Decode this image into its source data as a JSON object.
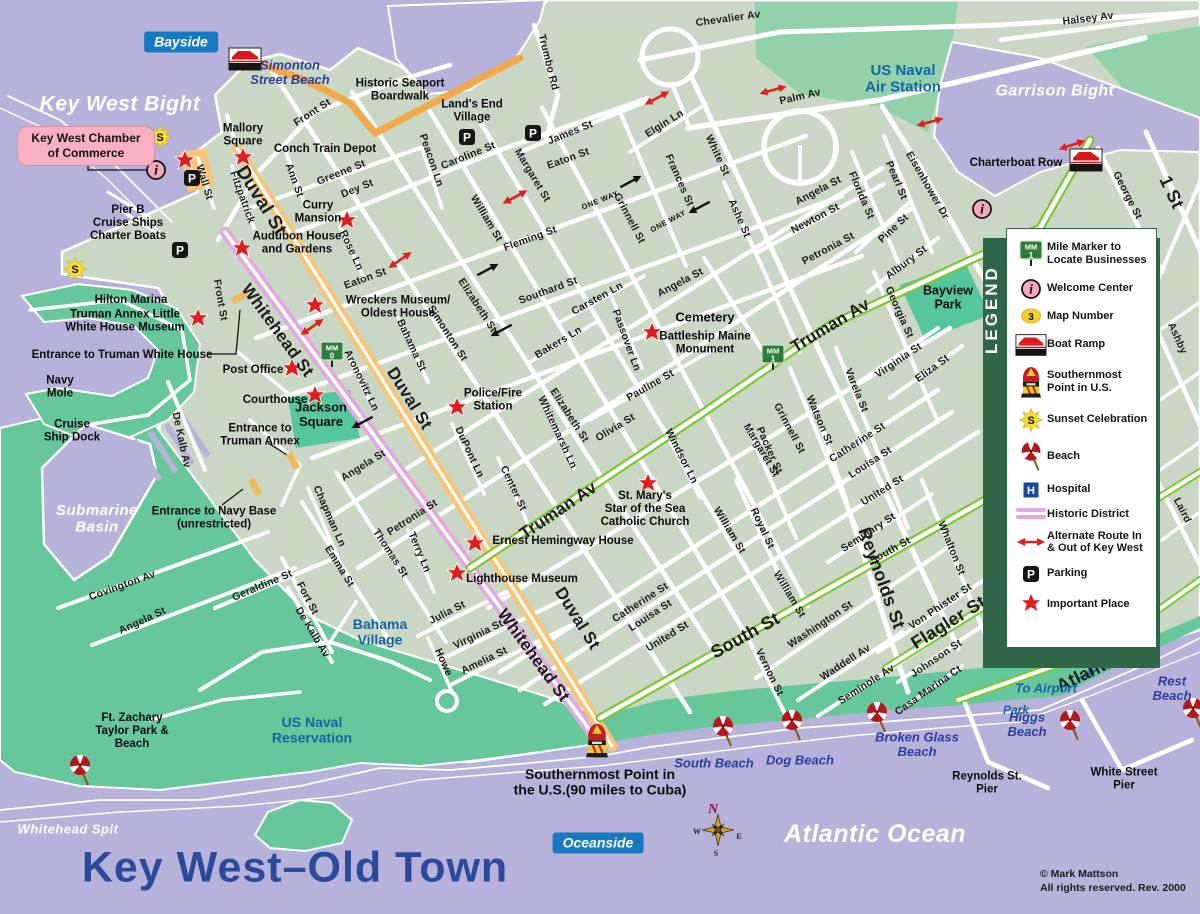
{
  "title": {
    "text": "Key West–Old Town"
  },
  "attribution": {
    "line1": "© Mark Mattson",
    "line2": "All rights reserved. Rev. 2000"
  },
  "badges": [
    {
      "text": "Bayside",
      "x": 181,
      "y": 42
    },
    {
      "text": "Oceanside",
      "x": 598,
      "y": 843
    }
  ],
  "chamber_box": {
    "line1": "Key West Chamber",
    "line2": "of Commerce"
  },
  "water_labels": [
    {
      "t": "Key West Bight",
      "x": 120,
      "y": 103,
      "s": 21
    },
    {
      "t": "Garrison Bight",
      "x": 1055,
      "y": 90,
      "s": 16
    },
    {
      "t": "Submarine\nBasin",
      "x": 97,
      "y": 518,
      "s": 15
    },
    {
      "t": "Whitehead Spit",
      "x": 68,
      "y": 829,
      "s": 13
    },
    {
      "t": "Atlantic Ocean",
      "x": 875,
      "y": 833,
      "s": 25
    }
  ],
  "area_labels": [
    {
      "t": "US Naval\nAir Station",
      "x": 903,
      "y": 78,
      "s": 15
    },
    {
      "t": "US Naval\nReservation",
      "x": 312,
      "y": 730,
      "s": 14
    },
    {
      "t": "Bahama\nVillage",
      "x": 380,
      "y": 632,
      "s": 14
    }
  ],
  "transit_labels": [
    {
      "t": "To Airport",
      "x": 1046,
      "y": 688,
      "s": 13
    },
    {
      "t": "Park",
      "x": 1016,
      "y": 710,
      "s": 12
    }
  ],
  "beach_labels": [
    {
      "t": "Simonton\nStreet Beach",
      "x": 290,
      "y": 72,
      "s": 13
    },
    {
      "t": "South Beach",
      "x": 714,
      "y": 763,
      "s": 13
    },
    {
      "t": "Dog Beach",
      "x": 800,
      "y": 760,
      "s": 13
    },
    {
      "t": "Broken Glass\nBeach",
      "x": 917,
      "y": 744,
      "s": 13
    },
    {
      "t": "Higgs\nBeach",
      "x": 1027,
      "y": 724,
      "s": 13
    },
    {
      "t": "Rest\nBeach",
      "x": 1172,
      "y": 688,
      "s": 13
    }
  ],
  "poi_labels": [
    {
      "t": "Mallory\nSquare",
      "x": 243,
      "y": 134
    },
    {
      "t": "Conch Train Depot",
      "x": 325,
      "y": 148
    },
    {
      "t": "Curry\nMansion",
      "x": 318,
      "y": 211
    },
    {
      "t": "Audubon House\nand Gardens",
      "x": 297,
      "y": 242
    },
    {
      "t": "Historic Seaport\nBoardwalk",
      "x": 400,
      "y": 89
    },
    {
      "t": "Land's End\nVillage",
      "x": 472,
      "y": 110
    },
    {
      "t": "Wreckers Museum/\nOldest House",
      "x": 398,
      "y": 306
    },
    {
      "t": "Truman Annex Little\nWhite House Museum",
      "x": 125,
      "y": 320
    },
    {
      "t": "Entrance to Truman White House",
      "x": 122,
      "y": 354
    },
    {
      "t": "Post Office",
      "x": 253,
      "y": 369
    },
    {
      "t": "Courthouse",
      "x": 275,
      "y": 399
    },
    {
      "t": "Jackson\nSquare",
      "x": 321,
      "y": 414,
      "s": 13
    },
    {
      "t": "Entrance to\nTruman Annex",
      "x": 260,
      "y": 434
    },
    {
      "t": "Entrance to Navy Base\n(unrestricted)",
      "x": 214,
      "y": 517
    },
    {
      "t": "Police/Fire\nStation",
      "x": 493,
      "y": 399
    },
    {
      "t": "Cemetery",
      "x": 705,
      "y": 317,
      "s": 13
    },
    {
      "t": "Battleship Maine\nMonument",
      "x": 705,
      "y": 342
    },
    {
      "t": "St. Mary's\nStar of the Sea\nCatholic Church",
      "x": 645,
      "y": 508
    },
    {
      "t": "Ernest Hemingway House",
      "x": 563,
      "y": 540
    },
    {
      "t": "Lighthouse Museum",
      "x": 522,
      "y": 578
    },
    {
      "t": "Pier B\nCruise Ships\nCharter Boats",
      "x": 128,
      "y": 222
    },
    {
      "t": "Hilton Marina",
      "x": 131,
      "y": 299
    },
    {
      "t": "Navy\nMole",
      "x": 60,
      "y": 386
    },
    {
      "t": "Cruise\nShip Dock",
      "x": 72,
      "y": 430
    },
    {
      "t": "Ft. Zachary\nTaylor Park &\nBeach",
      "x": 132,
      "y": 730
    },
    {
      "t": "Charterboat Row",
      "x": 1016,
      "y": 162
    },
    {
      "t": "Reynolds St.\nPier",
      "x": 987,
      "y": 782
    },
    {
      "t": "White Street\nPier",
      "x": 1124,
      "y": 778
    },
    {
      "t": "Bayview\nPark",
      "x": 948,
      "y": 297,
      "s": 12.5
    }
  ],
  "southernmost": {
    "t": "Southernmost Point in\nthe U.S.(90 miles to Cuba)",
    "x": 600,
    "y": 782,
    "s": 14
  },
  "street_labels": [
    [
      "Front St",
      312,
      112,
      -33
    ],
    [
      "Front St",
      221,
      300,
      80
    ],
    [
      "Wall St",
      205,
      182,
      73
    ],
    [
      "Fitzpatrick",
      243,
      197,
      70
    ],
    [
      "Ann St",
      295,
      180,
      70
    ],
    [
      "Greene St",
      341,
      172,
      -22
    ],
    [
      "Dey St",
      357,
      188,
      -22
    ],
    [
      "Caroline St",
      468,
      155,
      -22
    ],
    [
      "Peacon Ln",
      432,
      160,
      71
    ],
    [
      "James St",
      570,
      132,
      -22
    ],
    [
      "Trumbo Rd",
      549,
      62,
      76
    ],
    [
      "Chevalier Av",
      728,
      18,
      -8
    ],
    [
      "Halsey Av",
      1088,
      18,
      -7
    ],
    [
      "Palm Av",
      800,
      96,
      -13
    ],
    [
      "Elgin Ln",
      664,
      123,
      -32
    ],
    [
      "Eaton St",
      365,
      278,
      -20
    ],
    [
      "Eaton St",
      568,
      158,
      -20
    ],
    [
      "Fleming St",
      530,
      238,
      -20
    ],
    [
      "Southard St",
      548,
      290,
      -20
    ],
    [
      "Angela St",
      363,
      465,
      -32
    ],
    [
      "Angela St",
      680,
      282,
      -28
    ],
    [
      "Angela St",
      818,
      190,
      -28
    ],
    [
      "Angela St",
      142,
      620,
      -25
    ],
    [
      "Petronia St",
      412,
      517,
      -33
    ],
    [
      "Petronia St",
      828,
      248,
      -28
    ],
    [
      "Olivia St",
      615,
      427,
      -31
    ],
    [
      "Pauline St",
      650,
      385,
      -30
    ],
    [
      "Truman Av",
      558,
      510,
      -34,
      17
    ],
    [
      "Truman Av",
      830,
      325,
      -31,
      17
    ],
    [
      "Catherine St",
      640,
      602,
      -33
    ],
    [
      "Catherine St",
      857,
      442,
      -33
    ],
    [
      "Louisa St",
      650,
      615,
      -33
    ],
    [
      "Louisa St",
      870,
      462,
      -33
    ],
    [
      "United St",
      667,
      636,
      -32
    ],
    [
      "United St",
      882,
      490,
      -32
    ],
    [
      "Seminary St",
      868,
      532,
      -33
    ],
    [
      "South St",
      890,
      550,
      -29
    ],
    [
      "South St",
      745,
      635,
      -29,
      18
    ],
    [
      "Washington St",
      820,
      624,
      -34
    ],
    [
      "Waddell Av",
      845,
      662,
      -33
    ],
    [
      "Seminole Av",
      866,
      684,
      -33
    ],
    [
      "Von Phister St",
      940,
      606,
      -34
    ],
    [
      "Johnson St",
      936,
      658,
      -34
    ],
    [
      "Casa Marina Ct",
      928,
      690,
      -35
    ],
    [
      "Flagler St",
      948,
      622,
      -32,
      18
    ],
    [
      "Atlantic Blvd",
      1108,
      662,
      -26,
      18
    ],
    [
      "Julia St",
      447,
      612,
      -27
    ],
    [
      "Virginia St",
      478,
      634,
      -26
    ],
    [
      "Amelia St",
      484,
      660,
      -26
    ],
    [
      "Howe",
      444,
      662,
      66
    ],
    [
      "Whitehead St",
      278,
      330,
      54,
      17
    ],
    [
      "Whitehead St",
      534,
      655,
      54,
      17
    ],
    [
      "Duval St",
      262,
      200,
      58,
      19
    ],
    [
      "Duval St",
      410,
      398,
      58,
      17
    ],
    [
      "Duval St",
      578,
      618,
      58,
      17
    ],
    [
      "Simonton St",
      448,
      333,
      57
    ],
    [
      "Elizabeth St",
      478,
      305,
      57
    ],
    [
      "Elizabeth St",
      570,
      415,
      57
    ],
    [
      "William St",
      487,
      218,
      59
    ],
    [
      "William St",
      730,
      530,
      59
    ],
    [
      "William St",
      790,
      594,
      59
    ],
    [
      "Margaret St",
      533,
      175,
      59
    ],
    [
      "Margaret St",
      762,
      450,
      59
    ],
    [
      "Grinnell St",
      630,
      218,
      62
    ],
    [
      "Grinnell St",
      790,
      428,
      62
    ],
    [
      "Frances St",
      680,
      180,
      66
    ],
    [
      "White St",
      718,
      155,
      65
    ],
    [
      "Ashe St",
      740,
      218,
      66
    ],
    [
      "Newton St",
      815,
      218,
      -28
    ],
    [
      "Pine St",
      893,
      228,
      -43
    ],
    [
      "Florida St",
      862,
      195,
      67
    ],
    [
      "Pearl St",
      897,
      180,
      67
    ],
    [
      "Eisenhower Dr",
      928,
      185,
      60
    ],
    [
      "Albury St",
      906,
      262,
      -37
    ],
    [
      "Georgia St",
      900,
      312,
      66
    ],
    [
      "Virginia St",
      898,
      360,
      -34
    ],
    [
      "Eliza St",
      932,
      368,
      -36
    ],
    [
      "George St",
      1128,
      195,
      63
    ],
    [
      "1 St",
      1172,
      192,
      65,
      18
    ],
    [
      "Ashby",
      1178,
      338,
      66
    ],
    [
      "Laird",
      1183,
      510,
      63
    ],
    [
      "Bakers Ln",
      558,
      342,
      -31
    ],
    [
      "Carsten Ln",
      597,
      298,
      -29
    ],
    [
      "Passover Ln",
      627,
      340,
      70
    ],
    [
      "Windsor Ln",
      682,
      456,
      63
    ],
    [
      "Royal St",
      763,
      528,
      65
    ],
    [
      "Packer St",
      770,
      450,
      66
    ],
    [
      "Watson St",
      820,
      420,
      67
    ],
    [
      "Varela St",
      857,
      390,
      68
    ],
    [
      "Reynolds St",
      882,
      578,
      70,
      18
    ],
    [
      "Whalton St",
      952,
      548,
      68
    ],
    [
      "Vernon St",
      770,
      672,
      64
    ],
    [
      "Aronovitz Ln",
      362,
      380,
      64
    ],
    [
      "Bahama St",
      412,
      345,
      65
    ],
    [
      "Center St",
      514,
      488,
      65
    ],
    [
      "DuPont Ln",
      470,
      452,
      65
    ],
    [
      "Whitemarsh Ln",
      558,
      432,
      65
    ],
    [
      "Rose Ln",
      352,
      250,
      65
    ],
    [
      "Thomas St",
      391,
      553,
      57
    ],
    [
      "Terry Ln",
      420,
      552,
      67
    ],
    [
      "Emma St",
      340,
      566,
      58
    ],
    [
      "Chapman Ln",
      330,
      516,
      66
    ],
    [
      "Covington Av",
      122,
      585,
      -20
    ],
    [
      "Geraldine St",
      262,
      585,
      -23
    ],
    [
      "Fort St",
      308,
      598,
      62
    ],
    [
      "De Kalb Av",
      182,
      440,
      78
    ],
    [
      "De Kalb Av",
      313,
      632,
      59
    ]
  ],
  "one_way": [
    {
      "t": "ONE WAY",
      "x": 600,
      "y": 200,
      "r": -22
    },
    {
      "t": "ONE WAY",
      "x": 668,
      "y": 221,
      "r": -28
    }
  ],
  "legend": {
    "title": "LEGEND",
    "items": [
      {
        "icon": "mile-marker",
        "glyph": "1",
        "label": "Mile Marker to Locate Businesses"
      },
      {
        "icon": "welcome",
        "label": "Welcome Center"
      },
      {
        "icon": "map-number",
        "glyph": "3",
        "label": "Map Number"
      },
      {
        "icon": "boat-ramp",
        "label": "Boat Ramp"
      },
      {
        "icon": "buoy",
        "label": "Southernmost Point in U.S."
      },
      {
        "icon": "sunset",
        "label": "Sunset Celebration"
      },
      {
        "icon": "beach",
        "label": "Beach"
      },
      {
        "icon": "hospital",
        "label": "Hospital"
      },
      {
        "icon": "historic",
        "label": "Historic District"
      },
      {
        "icon": "alt-route",
        "label": "Alternate Route In & Out of Key West"
      },
      {
        "icon": "parking",
        "label": "Parking"
      },
      {
        "icon": "star",
        "label": "Important Place"
      }
    ]
  },
  "icons": {
    "stars": [
      [
        185,
        160
      ],
      [
        243,
        157
      ],
      [
        347,
        220
      ],
      [
        242,
        248
      ],
      [
        315,
        305
      ],
      [
        198,
        318
      ],
      [
        292,
        368
      ],
      [
        315,
        395
      ],
      [
        457,
        407
      ],
      [
        652,
        332
      ],
      [
        648,
        483
      ],
      [
        475,
        543
      ],
      [
        457,
        573
      ]
    ],
    "parking": [
      [
        192,
        178
      ],
      [
        180,
        250
      ],
      [
        467,
        137
      ],
      [
        533,
        133
      ]
    ],
    "sunset": [
      [
        160,
        137
      ],
      [
        75,
        269
      ]
    ],
    "welcome": [
      [
        156,
        170
      ],
      [
        982,
        209
      ]
    ],
    "boat_ramp": [
      [
        245,
        59
      ],
      [
        1086,
        160
      ]
    ],
    "mile_markers": [
      {
        "x": 332,
        "y": 352,
        "n": "0"
      },
      {
        "x": 773,
        "y": 355,
        "n": "1"
      }
    ],
    "umbrellas": [
      [
        80,
        765
      ],
      [
        723,
        726
      ],
      [
        792,
        720
      ],
      [
        877,
        712
      ],
      [
        1070,
        720
      ],
      [
        1193,
        708
      ]
    ],
    "buoy": [
      597,
      737
    ],
    "compass": {
      "x": 718,
      "y": 830,
      "n": "N",
      "w": "W",
      "e": "E",
      "s": "S"
    },
    "red_arrows": [
      [
        657,
        98,
        -28
      ],
      [
        773,
        90,
        -15
      ],
      [
        930,
        122,
        -15
      ],
      [
        1072,
        145,
        -18
      ],
      [
        515,
        197,
        -28
      ],
      [
        400,
        260,
        -35
      ],
      [
        312,
        327,
        -35
      ]
    ],
    "black_arrows": [
      [
        630,
        182,
        -28
      ],
      [
        700,
        207,
        152
      ],
      [
        502,
        330,
        152
      ],
      [
        363,
        422,
        152
      ],
      [
        487,
        270,
        -28
      ]
    ],
    "gates": [
      [
        240,
        297,
        62
      ],
      [
        293,
        461,
        -28
      ],
      [
        255,
        487,
        -28
      ]
    ]
  },
  "colors": {
    "water": "#b6b2d9",
    "land": "#cad7c4",
    "park_green": "#66c79b",
    "naval_green": "#93d1ab",
    "teal_park": "#56c69e",
    "legend_green": "#2f6648",
    "duval_orange": "#f7c575",
    "boardwalk_orange": "#f2a94c",
    "historic_pink": "#e2a9de",
    "route_green": "#7cc832",
    "star_red": "#e11c1f",
    "title_blue": "#2b4a9c",
    "beach_blue": "#2a3f9f",
    "naval_blue": "#1565a5",
    "badge_blue": "#1779c2",
    "chamber_pink": "#f8b0c2"
  }
}
